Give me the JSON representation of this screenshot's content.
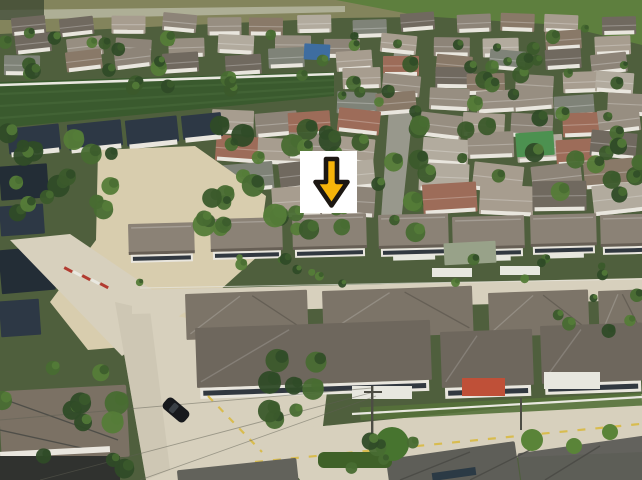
{
  "image": {
    "type": "aerial-photograph",
    "description": "Drone aerial view of a suburban housing estate with tree-lined lanes, a dense older village at top, rows of modern dark-roofed houses below, pale concrete roads with a black car, and a white square overlay containing a yellow down-arrow marker pointing at one row of houses."
  },
  "marker": {
    "icon": "down-arrow-icon",
    "box_color": "#ffffff",
    "arrow_color": "#f6b40a",
    "outline_color": "#1c1712",
    "x": 300,
    "y": 151,
    "width": 57,
    "height": 62
  },
  "palette": {
    "scrub": "#83845c",
    "grass_field": "#5e7f3e",
    "top_path": "#b6b6a0",
    "estate_ground": "#4f5f3d",
    "field_green": "#3a5a2e",
    "field_stripe": "#446637",
    "fence_white": "#e9e8e0",
    "wall_white": "#e9e6de",
    "window_dark": "#313840",
    "dark_roof": "#2d3845",
    "dark_roof_deep": "#232d36",
    "sand": "#d8cdae",
    "road": "#d7d0bd",
    "road_shade": "#c3bca9",
    "asphalt": "#98988c",
    "m1_roof": "#8b8276",
    "m1_eave": "#675f55",
    "m2a_roof": "#7c7468",
    "m2b_roof": "#6e675d",
    "awning_orange": "#bf5038",
    "awning_white": "#e7e7df",
    "brown_roof": "#7b7164",
    "bottom_dark_roof": "#5e5e58",
    "ridge": "#4b4b46",
    "hedge": "#3f6128",
    "bush": "#5a8438",
    "car_black": "#17191d",
    "wire": "#5f5f54",
    "lane_yellow": "#d8b93c",
    "rumble_red": "#b23b30",
    "marker_white": "#ffffff",
    "arrow_yellow": "#f6b40a",
    "arrow_outline": "#1c1712",
    "accent_blue": "#3e6da0",
    "accent_green_net": "#4c9150"
  },
  "scene": {
    "seed": 20240613,
    "house_palette": [
      "#b2ab9e",
      "#978e81",
      "#897968",
      "#9d6c59",
      "#7f8378",
      "#a79d8f",
      "#70695f",
      "#8d8478"
    ],
    "tree_palette": [
      "#2f4b27",
      "#3b5a2b",
      "#486c31",
      "#557c38"
    ],
    "house_rows": [
      {
        "y": 26,
        "w": 34,
        "h": 18,
        "spans": [
          [
            0,
            642,
            13
          ]
        ]
      },
      {
        "y": 44,
        "w": 36,
        "h": 19,
        "spans": [
          [
            0,
            642,
            12
          ]
        ]
      },
      {
        "y": 62,
        "w": 36,
        "h": 20,
        "spans": [
          [
            0,
            642,
            12
          ]
        ]
      },
      {
        "y": 82,
        "w": 38,
        "h": 21,
        "spans": [
          [
            338,
            642,
            7
          ]
        ]
      },
      {
        "y": 102,
        "w": 40,
        "h": 22,
        "spans": [
          [
            338,
            642,
            7
          ]
        ]
      },
      {
        "y": 124,
        "w": 42,
        "h": 24,
        "spans": [
          [
            210,
            376,
            4
          ],
          [
            424,
            642,
            5
          ]
        ]
      },
      {
        "y": 148,
        "w": 46,
        "h": 26,
        "spans": [
          [
            216,
            376,
            4
          ],
          [
            424,
            642,
            5
          ]
        ]
      },
      {
        "y": 174,
        "w": 50,
        "h": 28,
        "spans": [
          [
            224,
            376,
            3
          ],
          [
            424,
            642,
            4
          ]
        ]
      },
      {
        "y": 200,
        "w": 54,
        "h": 30,
        "spans": [
          [
            272,
            378,
            2
          ],
          [
            424,
            642,
            4
          ]
        ]
      }
    ],
    "tree_zones": [
      [
        0,
        24,
        640,
        42,
        18,
        4,
        8
      ],
      [
        0,
        58,
        336,
        32,
        14,
        4,
        9
      ],
      [
        336,
        58,
        306,
        62,
        22,
        4,
        9
      ],
      [
        196,
        118,
        144,
        122,
        26,
        6,
        12
      ],
      [
        330,
        118,
        92,
        116,
        15,
        5,
        10
      ],
      [
        420,
        118,
        222,
        100,
        19,
        5,
        10
      ],
      [
        0,
        126,
        112,
        112,
        16,
        6,
        12
      ],
      [
        0,
        342,
        126,
        136,
        11,
        7,
        14
      ],
      [
        130,
        256,
        510,
        28,
        16,
        3,
        6
      ],
      [
        556,
        294,
        86,
        44,
        6,
        4,
        8
      ],
      [
        256,
        348,
        78,
        84,
        8,
        6,
        12
      ],
      [
        330,
        428,
        88,
        46,
        5,
        5,
        9
      ]
    ],
    "m1_houses": [
      {
        "x": 128,
        "y": 224,
        "w": 66,
        "h": 44,
        "awn": 0
      },
      {
        "x": 210,
        "y": 219,
        "w": 72,
        "h": 46,
        "awn": 0
      },
      {
        "x": 292,
        "y": 215,
        "w": 74,
        "h": 48,
        "awn": 0
      },
      {
        "x": 378,
        "y": 215,
        "w": 70,
        "h": 47,
        "awn": 1
      },
      {
        "x": 452,
        "y": 217,
        "w": 72,
        "h": 46,
        "awn": 1
      },
      {
        "x": 530,
        "y": 215,
        "w": 66,
        "h": 45,
        "awn": 1
      },
      {
        "x": 600,
        "y": 215,
        "w": 46,
        "h": 45,
        "awn": 0
      }
    ],
    "m2a_roofs": [
      {
        "x": 185,
        "y": 294,
        "w": 122,
        "h": 46
      },
      {
        "x": 322,
        "y": 291,
        "w": 150,
        "h": 48
      },
      {
        "x": 488,
        "y": 293,
        "w": 100,
        "h": 44
      },
      {
        "x": 598,
        "y": 291,
        "w": 44,
        "h": 44
      }
    ],
    "m2b_houses": [
      {
        "x": 195,
        "y": 328,
        "w": 235,
        "h": 60
      },
      {
        "x": 440,
        "y": 332,
        "w": 92,
        "h": 56
      },
      {
        "x": 540,
        "y": 326,
        "w": 102,
        "h": 58
      }
    ]
  }
}
